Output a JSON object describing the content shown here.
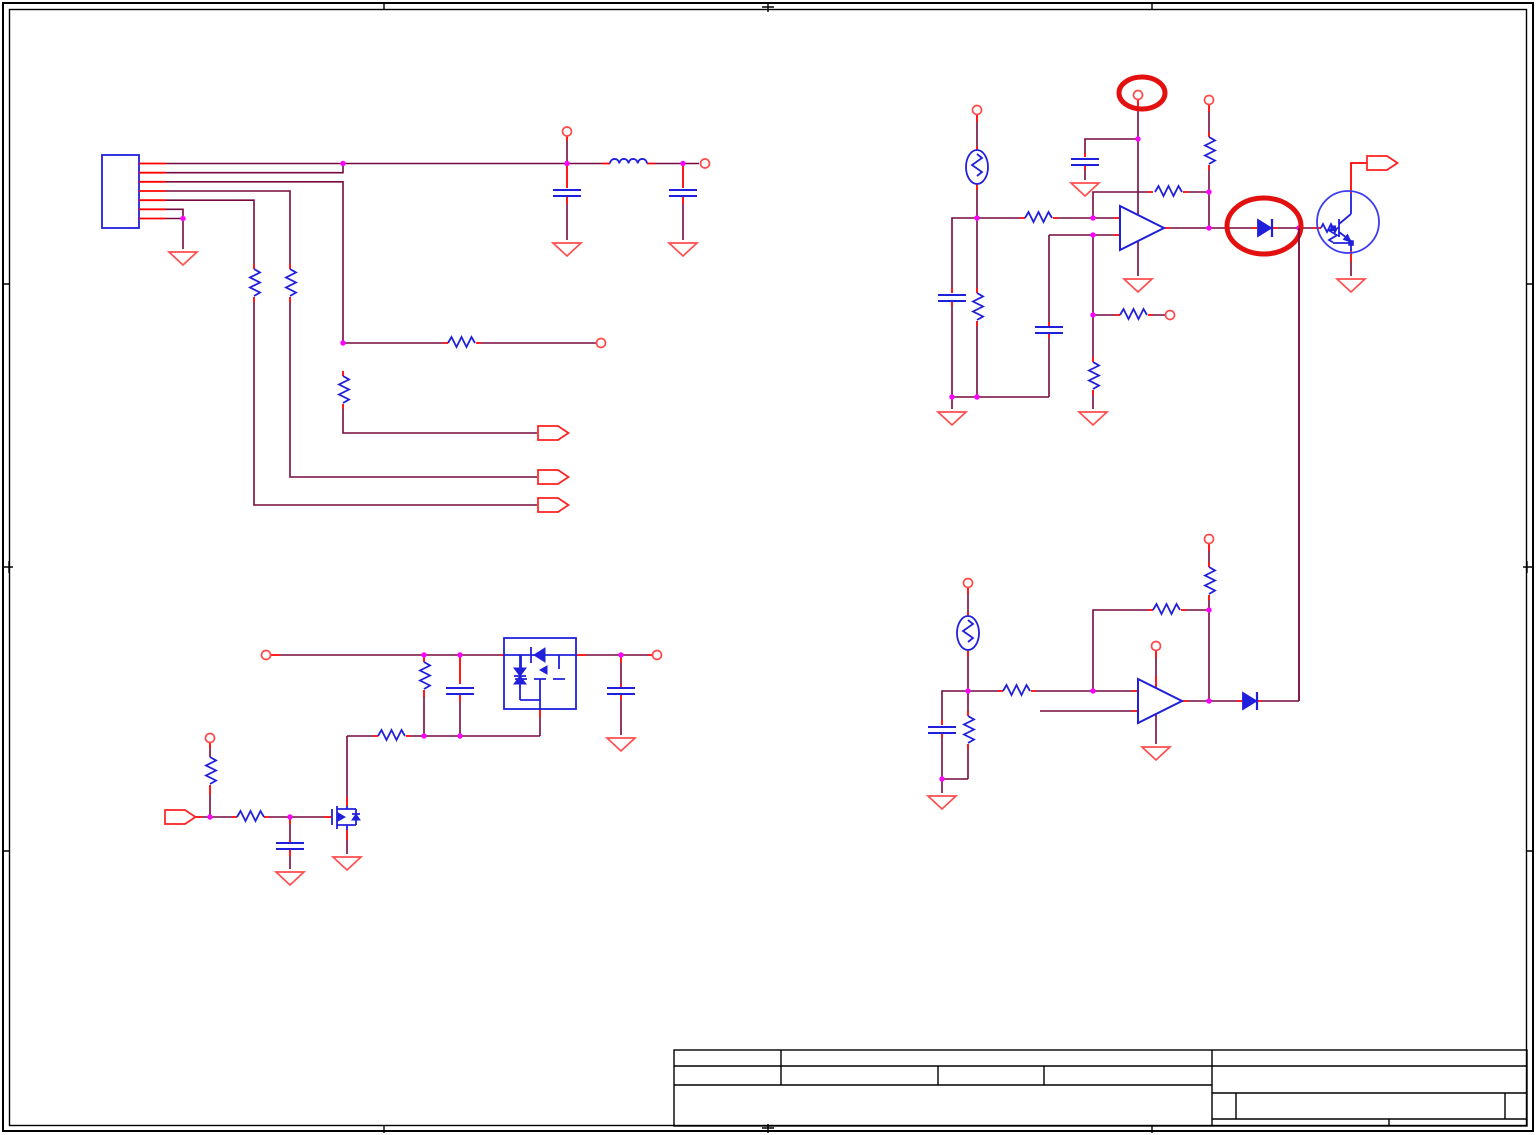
{
  "page": {
    "kind": "circuit-schematic-sheet",
    "width_px": 1536,
    "height_px": 1135,
    "visible_text": "",
    "background": "#ffffff"
  },
  "colors": {
    "bg": "#ffffff",
    "frame": "#000000",
    "wire": "#75093f",
    "pin": "#ff0000",
    "part": "#2020dc",
    "junction": "#ff00ff",
    "port": "#ff4848",
    "ground": "#ff4d4d",
    "offpage": "#ff1f1f",
    "annotation": "#e31010",
    "circlemark": "#3c3cf0"
  },
  "title_block": {
    "present": true,
    "all_cells_empty": true,
    "cell_text": [
      "",
      "",
      "",
      "",
      "",
      "",
      "",
      "",
      "",
      "",
      "",
      ""
    ]
  },
  "annotations": [
    {
      "shape": "ellipse",
      "style": "thick-red",
      "target": "comparator-power-port-highlight"
    },
    {
      "shape": "ellipse",
      "style": "thick-red",
      "target": "output-or-diode-highlight"
    },
    {
      "shape": "circle",
      "style": "thin-blue",
      "target": "digital-transistor-outline"
    }
  ],
  "components": {
    "connector_block": {
      "type": "7-pin-connector",
      "pins": 7,
      "grounded_pins": 2
    },
    "emi_pi_filter": {
      "capacitors": 2,
      "inductors": 1,
      "ports": 3,
      "grounds": 2
    },
    "divider_network": {
      "resistors": 4,
      "ports": 1,
      "offpage_connectors_right": 3
    },
    "thermistor_comparator_top": {
      "thermistor": 1,
      "opamp_comparator": 1,
      "resistors": 6,
      "capacitors": 3,
      "ports": 4,
      "grounds": 4,
      "series_diode": 1,
      "digital_transistor": 1,
      "offpage_connector": 1
    },
    "thermistor_comparator_bottom": {
      "thermistor": 1,
      "opamp_comparator": 1,
      "resistors": 4,
      "capacitors": 1,
      "ports": 3,
      "grounds": 2,
      "series_diode": 1
    },
    "load_switch": {
      "dual_pfet_package": 1,
      "nfet": 1,
      "resistors": 4,
      "capacitors": 3,
      "ports": 3,
      "grounds": 3,
      "offpage_connector_input": 1
    }
  }
}
